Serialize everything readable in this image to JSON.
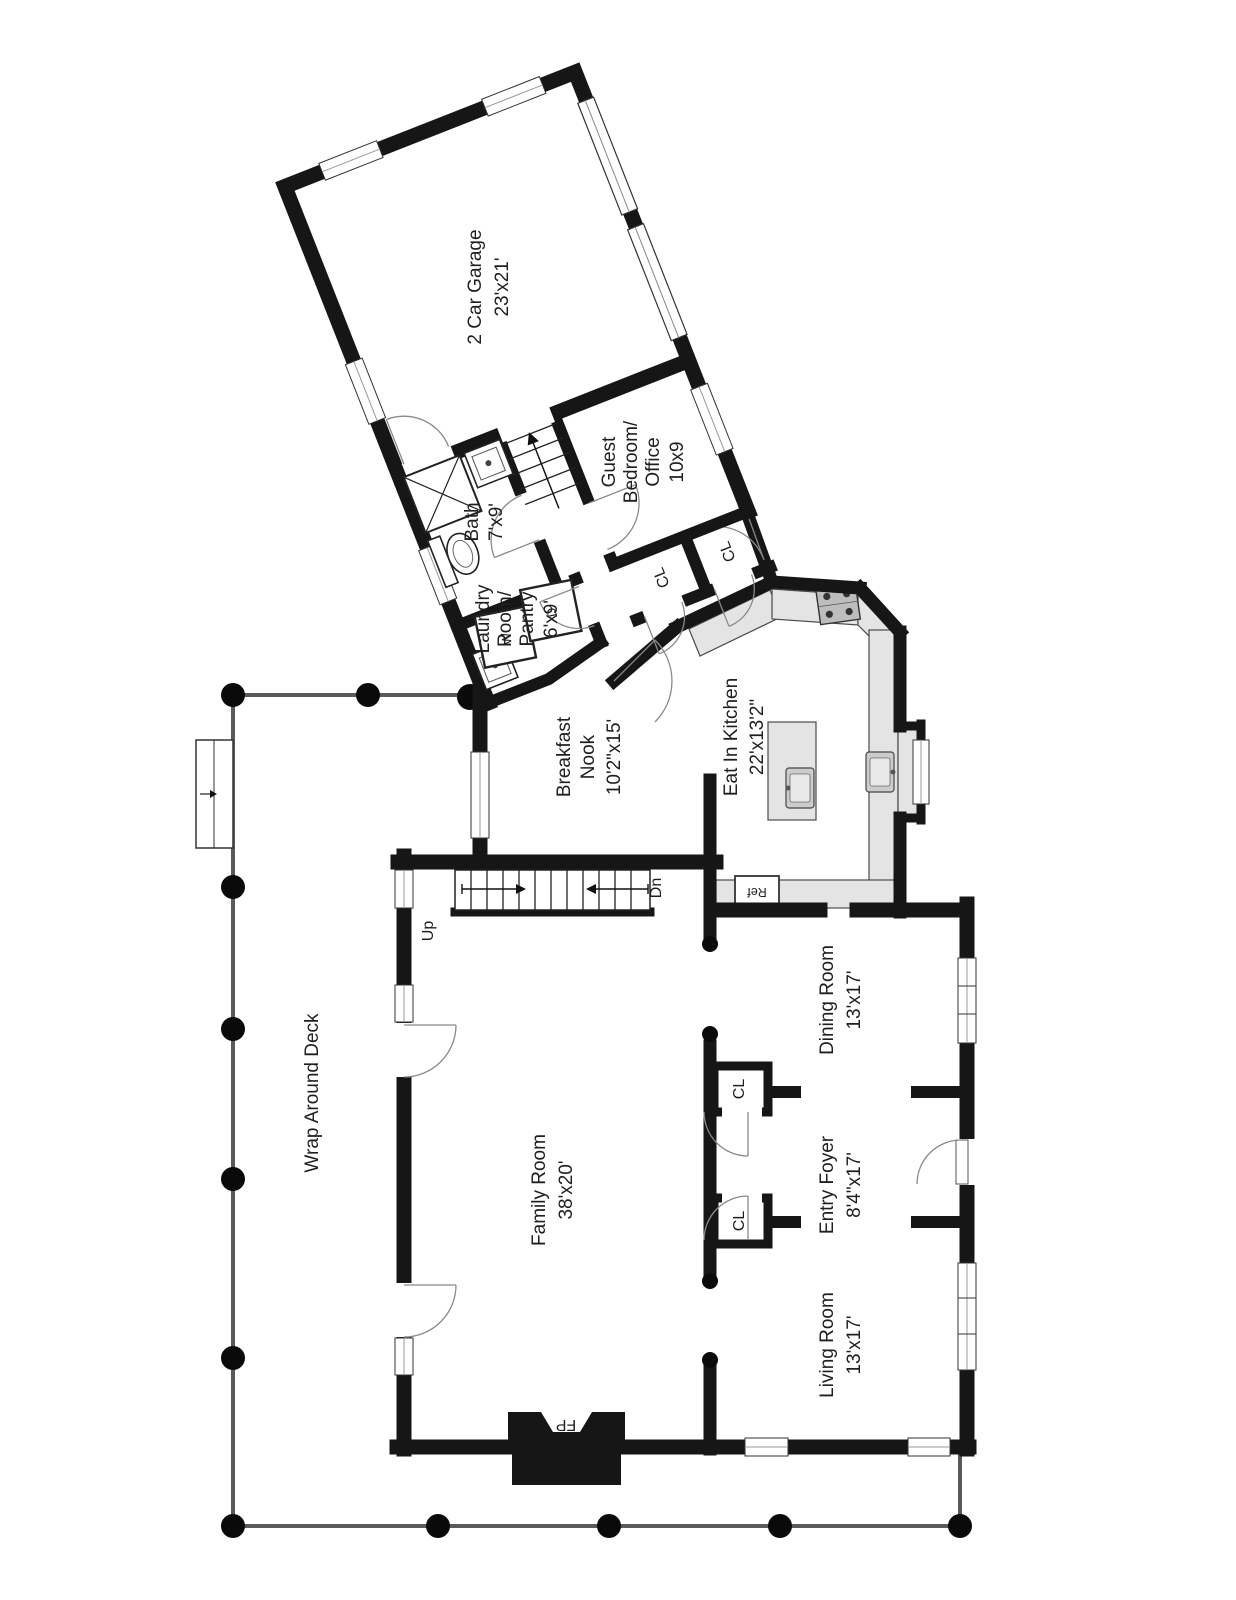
{
  "plan": {
    "title": "First floor plan",
    "rooms": {
      "garage": {
        "name": "2 Car Garage",
        "dims": "23'x21'"
      },
      "bath": {
        "name": "Bath",
        "dims": "7'x9'"
      },
      "guest_bedroom": {
        "line1": "Guest",
        "line2": "Bedroom/",
        "line3": "Office",
        "dims": "10x9"
      },
      "laundry": {
        "line1": "Laundry",
        "line2": "Room/",
        "line3": "Pantry",
        "dims": "6'x9'"
      },
      "breakfast_nook": {
        "line1": "Breakfast",
        "line2": "Nook",
        "dims": "10'2\"x15'"
      },
      "kitchen": {
        "name": "Eat In Kitchen",
        "dims": "22'x13'2\""
      },
      "dining": {
        "name": "Dining Room",
        "dims": "13'x17'"
      },
      "family": {
        "name": "Family Room",
        "dims": "38'x20'"
      },
      "foyer": {
        "name": "Entry Foyer",
        "dims": "8'4\"x17'"
      },
      "living": {
        "name": "Living Room",
        "dims": "13'x17'"
      },
      "deck": {
        "name": "Wrap Around Deck"
      }
    },
    "fixtures": {
      "up": "Up",
      "down": "Dn",
      "refrigerator": "Ref",
      "fireplace": "FP",
      "closet": "CL",
      "washer": "W",
      "dryer": "D"
    },
    "colors": {
      "wall": "#161616",
      "counter": "#e4e4e4",
      "deck_rail": "#5a5a5a",
      "column": "#0a0a0a",
      "text": "#1f1f1f",
      "door_arc": "#8a8a8a"
    }
  }
}
